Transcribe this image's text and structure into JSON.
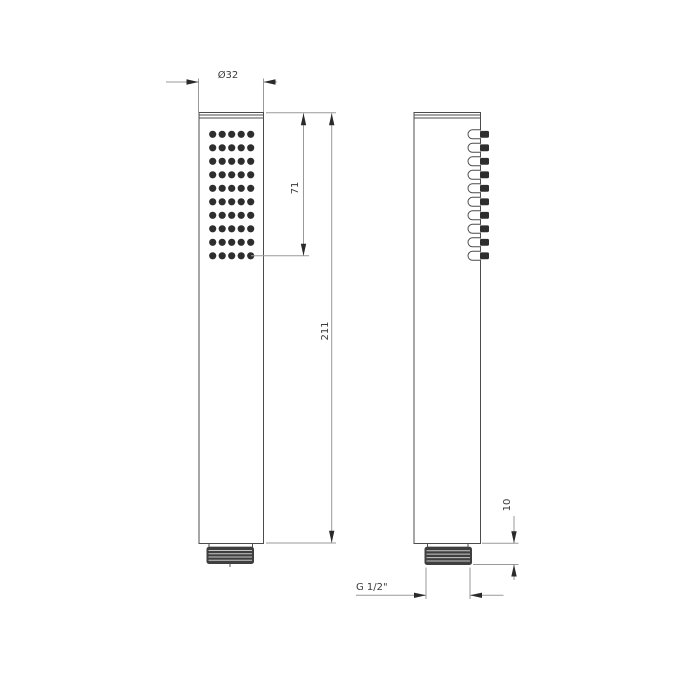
{
  "page": {
    "background_color": "#ffffff",
    "title": "Hand shower technical dimension drawing"
  },
  "drawing": {
    "type": "technical-dimension-drawing",
    "views": {
      "front_view": {
        "name": "front view (spray face)",
        "nozzle_grid": {
          "columns": 5,
          "rows": 10
        },
        "features": [
          "spray face with nozzle dots",
          "cylindrical handle",
          "threaded connector"
        ]
      },
      "side_view": {
        "name": "side view (profile)",
        "nozzle_rows": 10,
        "features": [
          "protruding nozzles",
          "cylindrical handle",
          "threaded connector"
        ]
      }
    },
    "labels": {
      "diameter": "Ø32",
      "face_length": "71",
      "total_length": "211",
      "thread_length": "10",
      "thread_spec": "G 1/2\""
    },
    "colors": {
      "outline": "#4c4c4c",
      "dimension_line": "#9a9a9a",
      "arrow": "#2a2a2a",
      "text": "#3a3a3a",
      "nozzle_dot": "#2e2e2e",
      "thread_dark": "#3f3f3f",
      "thread_ridge": "#c9c9c9",
      "fill": "#ffffff"
    }
  }
}
